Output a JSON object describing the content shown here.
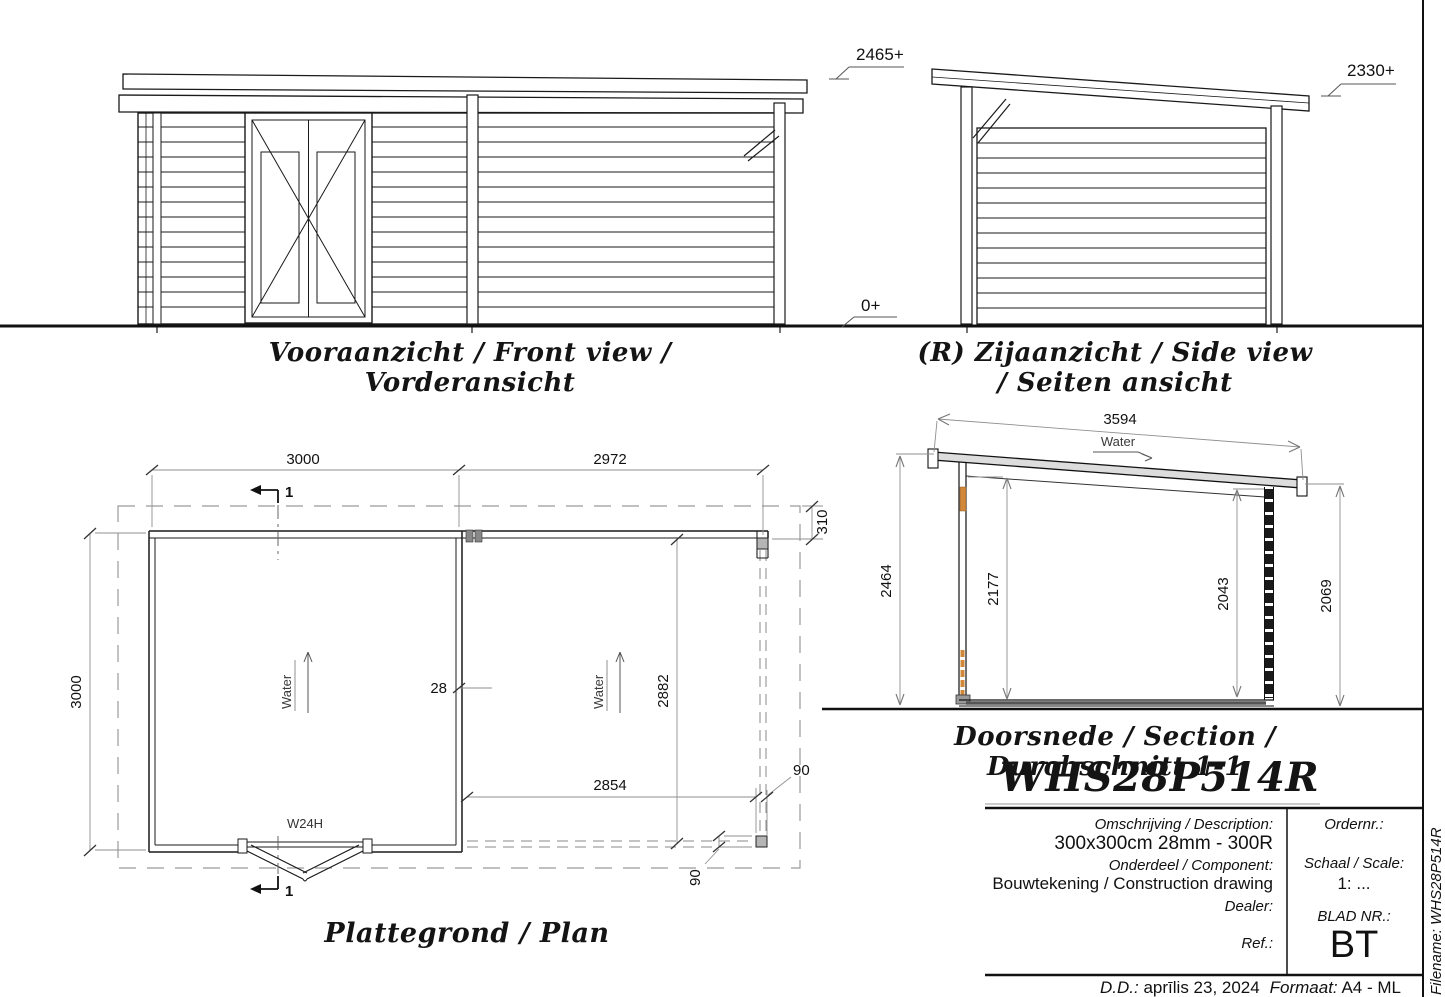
{
  "levels": {
    "front_top": "2465+",
    "ground": "0+",
    "side_top": "2330+"
  },
  "front_view": {
    "title": "Vooraanzicht / Front view / Vorderansicht"
  },
  "side_view": {
    "title": "(R) Zijaanzicht / Side view / Seiten ansicht"
  },
  "plan": {
    "title": "Plattegrond / Plan",
    "door_label": "W24H",
    "water_label": "Water",
    "section_mark": "1",
    "dims": {
      "width_left": "3000",
      "width_right": "2972",
      "height_left": "3000",
      "height_inner": "2882",
      "porch_width": "2854",
      "overhang": "310",
      "post_width": "90",
      "post_depth": "90",
      "wall_thickness": "28"
    }
  },
  "section": {
    "title": "Doorsnede / Section / Durchschnitt 1-1",
    "water_label": "Water",
    "dims": {
      "roof_length": "3594",
      "left_outer": "2464",
      "left_inner": "2177",
      "right_inner": "2043",
      "right_outer": "2069"
    }
  },
  "title_block": {
    "model": "WHS28P514R",
    "description_label": "Omschrijving / Description:",
    "description": "300x300cm 28mm - 300R",
    "component_label": "Onderdeel / Component:",
    "component": "Bouwtekening / Construction drawing",
    "dealer_label": "Dealer:",
    "ref_label": "Ref.:",
    "order_label": "Ordernr.:",
    "scale_label": "Schaal / Scale:",
    "scale_value": "1: ...",
    "sheet_label": "BLAD NR.:",
    "sheet_value": "BT",
    "filename": "Filename: WHS28P514R",
    "date_label": "D.D.:",
    "date_value": "aprīlis 23, 2024",
    "format_label": "Formaat:",
    "format_value": "A4 - ML"
  }
}
